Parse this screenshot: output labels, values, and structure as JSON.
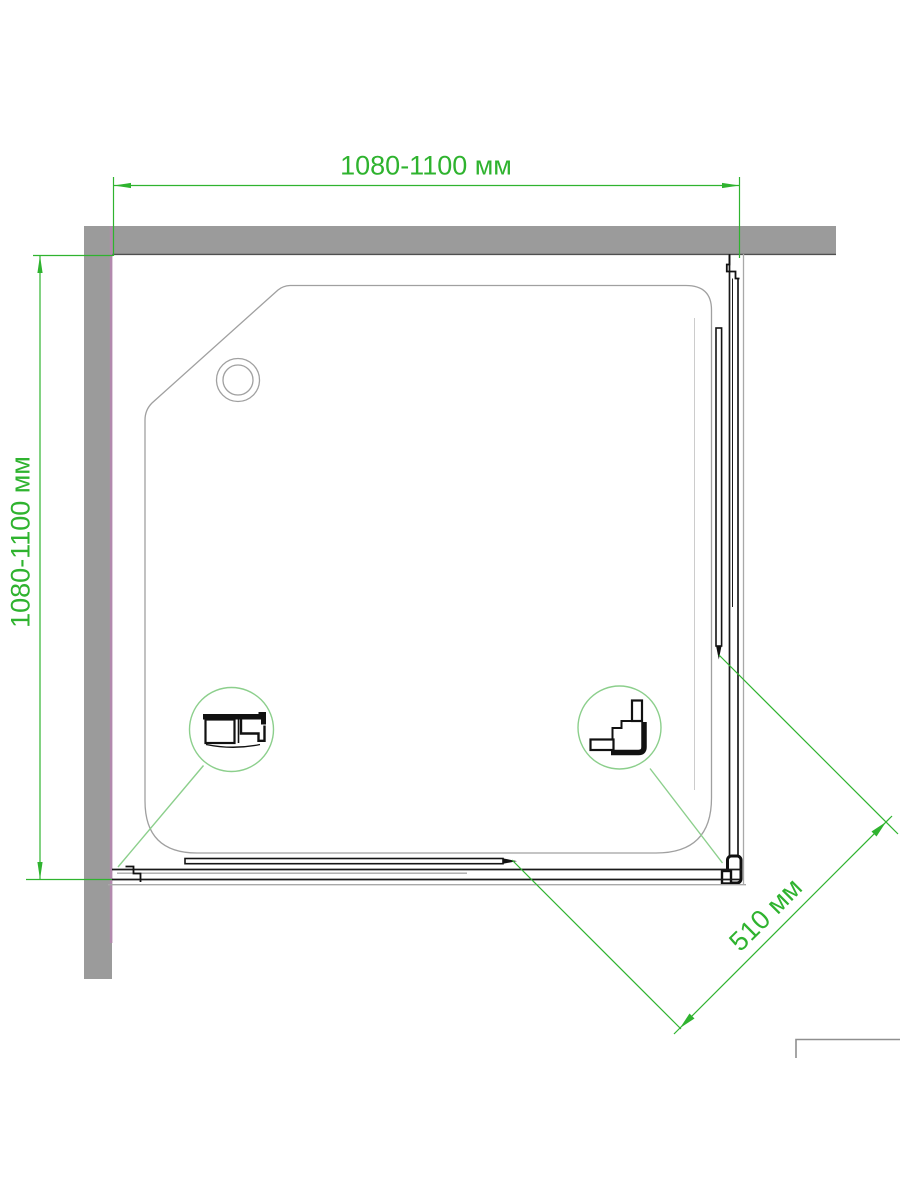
{
  "title": "Corner shower enclosure — top view installation drawing",
  "colors": {
    "dim-green": "#2fb32f",
    "detail-green": "#8ccf8c",
    "wall-gray": "#9b9b9b",
    "wall-accent": "#b289ad",
    "line-black": "#1a1a1a",
    "line-gray": "#a0a0a0"
  },
  "dimensions": {
    "width": {
      "label": "1080-1100 мм"
    },
    "height": {
      "label": "1080-1100 мм"
    },
    "diagonal": {
      "label": "510 мм"
    }
  }
}
